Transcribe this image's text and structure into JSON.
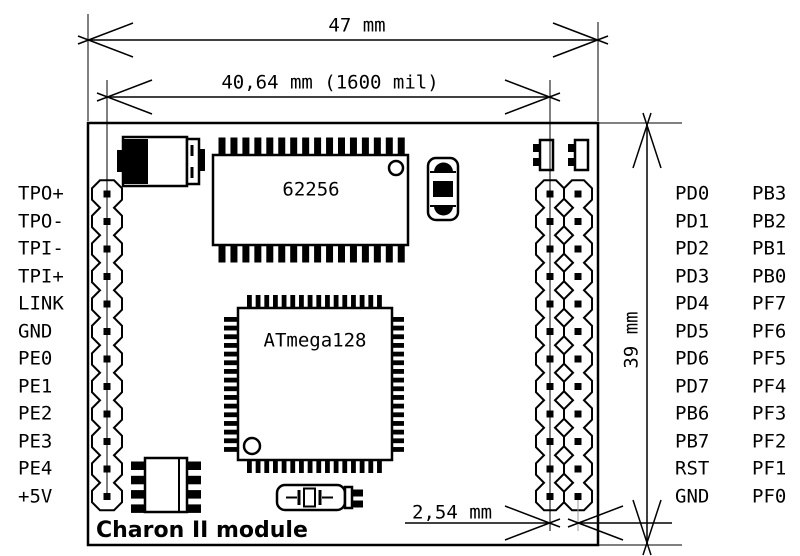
{
  "diagram": {
    "title": "Charon II module",
    "board": {
      "sram_label": "62256",
      "mcu_label": "ATmega128"
    },
    "dimensions": {
      "board_width": "47 mm",
      "pin_span": "40,64 mm (1600 mil)",
      "board_height": "39 mm",
      "pin_pitch": "2,54 mm"
    },
    "left_header_pins": [
      "TPO+",
      "TPO-",
      "TPI-",
      "TPI+",
      "LINK",
      "GND",
      "PE0",
      "PE1",
      "PE2",
      "PE3",
      "PE4",
      "+5V"
    ],
    "right_header_pins_inner": [
      "PD0",
      "PD1",
      "PD2",
      "PD3",
      "PD4",
      "PD5",
      "PD6",
      "PD7",
      "PB6",
      "PB7",
      "RST",
      "GND"
    ],
    "right_header_pins_outer": [
      "PB3",
      "PB2",
      "PB1",
      "PB0",
      "PF7",
      "PF6",
      "PF5",
      "PF4",
      "PF3",
      "PF2",
      "PF1",
      "PF0"
    ],
    "colors": {
      "line": "#000000",
      "background": "#ffffff"
    }
  }
}
